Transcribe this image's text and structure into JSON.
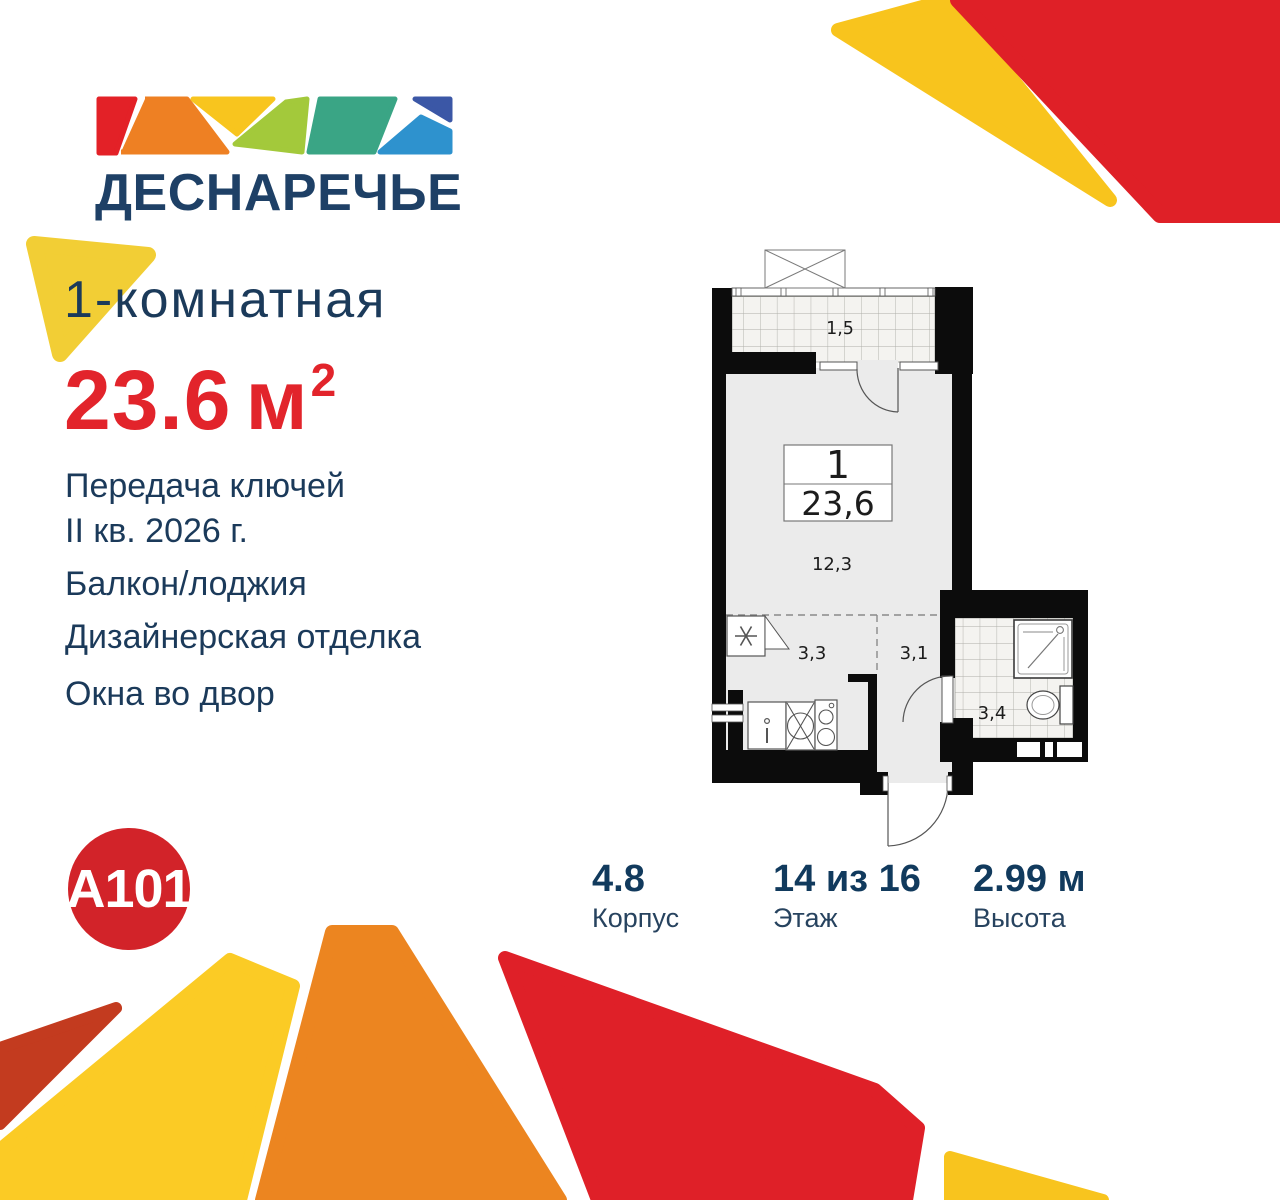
{
  "brand": {
    "name": "ДЕСНАРЕЧЬЕ",
    "developer": "A101"
  },
  "listing": {
    "rooms_title": "1-комнатная",
    "area_value": "23.6",
    "area_unit": "м",
    "area_exp": "2",
    "handover_line1": "Передача ключей",
    "handover_line2": "II кв. 2026 г.",
    "feature_balcony": "Балкон/лоджия",
    "feature_finish": "Дизайнерская отделка",
    "feature_windows": "Окна во двор"
  },
  "plan": {
    "unit_number": "1",
    "unit_area": "23,6",
    "balcony_area": "1,5",
    "living_area": "12,3",
    "kitchen_area": "3,3",
    "hall_area": "3,1",
    "bath_area": "3,4"
  },
  "stats": {
    "building": {
      "value": "4.8",
      "label": "Корпус"
    },
    "floor": {
      "value": "14 из 16",
      "label": "Этаж"
    },
    "height": {
      "value": "2.99 м",
      "label": "Высота"
    }
  },
  "colors": {
    "navy": "#1b3a5a",
    "accent_red": "#e2242b",
    "brand_red": "#d22329",
    "decor_yellow": "#f8c41d",
    "decor_orange": "#ec8520",
    "decor_brick": "#c33b1f",
    "plan_floor": "#ebebeb",
    "plan_wall": "#0c0c0c"
  }
}
